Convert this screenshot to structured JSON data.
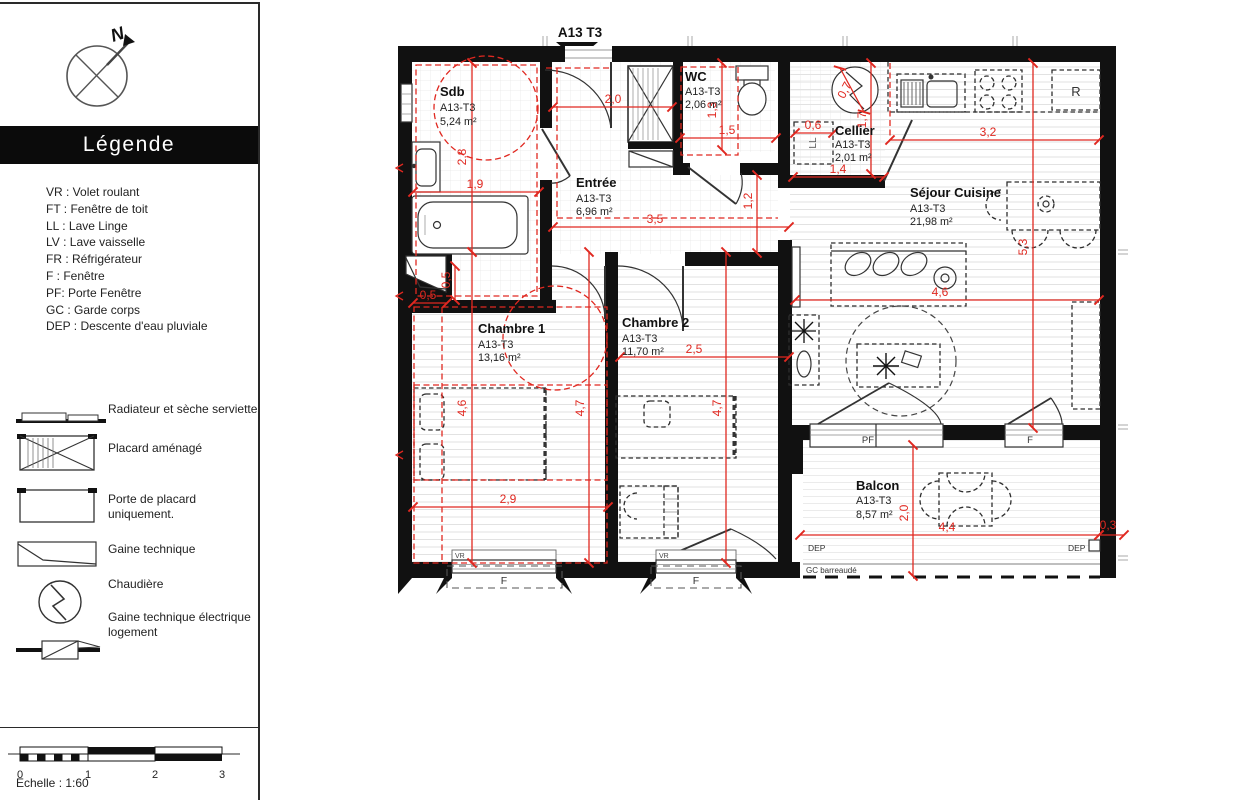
{
  "header": {
    "unit": "A13 T3"
  },
  "compass": {
    "north": "N"
  },
  "legend": {
    "title": "Légende",
    "abbreviations": [
      "VR : Volet roulant",
      "FT : Fenêtre de toit",
      "LL : Lave Linge",
      "LV : Lave vaisselle",
      "FR : Réfrigérateur",
      "F : Fenêtre",
      "PF: Porte Fenêtre",
      "GC : Garde corps",
      "DEP : Descente d'eau pluviale"
    ],
    "symbols": [
      "Radiateur et sèche serviette",
      "Placard aménagé",
      "Porte de placard uniquement.",
      "Gaine technique",
      "Chaudière",
      "Gaine technique électrique logement"
    ],
    "scale": {
      "ticks": [
        "0",
        "1",
        "2",
        "3"
      ],
      "label": "Echelle : 1:60"
    }
  },
  "plan": {
    "rooms": [
      {
        "name": "Sdb",
        "type": "A13-T3",
        "area": "5,24 m²"
      },
      {
        "name": "WC",
        "type": "A13-T3",
        "area": "2,06 m²"
      },
      {
        "name": "Entrée",
        "type": "A13-T3",
        "area": "6,96 m²"
      },
      {
        "name": "Cellier",
        "type": "A13-T3",
        "area": "2,01 m²"
      },
      {
        "name": "Séjour Cuisine",
        "type": "A13-T3",
        "area": "21,98 m²"
      },
      {
        "name": "Chambre 1",
        "type": "A13-T3",
        "area": "13,16 m²"
      },
      {
        "name": "Chambre 2",
        "type": "A13-T3",
        "area": "11,70 m²"
      },
      {
        "name": "Balcon",
        "type": "A13-T3",
        "area": "8,57 m²"
      }
    ],
    "dims": [
      "2,0",
      "1,3",
      "1,5",
      "0,6",
      "1,4",
      "0,7",
      "1,7",
      "3,2",
      "2,8",
      "1,9",
      "3,5",
      "1,2",
      "0,5",
      "0,5",
      "4,6",
      "4,7",
      "2,5",
      "4,7",
      "2,9",
      "4,6",
      "5,3",
      "2,0",
      "4,4",
      "0,3"
    ],
    "labels": {
      "fridge": "R",
      "washing_machine": "LL",
      "french_window": "PF",
      "window": "F",
      "roller_shutter": "VR",
      "rain_downpipe": "DEP",
      "guardrail": "GC barreaudé"
    }
  },
  "colors": {
    "dimension_red": "#e02820",
    "wall_black": "#111111",
    "drawing_gray": "#333333"
  }
}
